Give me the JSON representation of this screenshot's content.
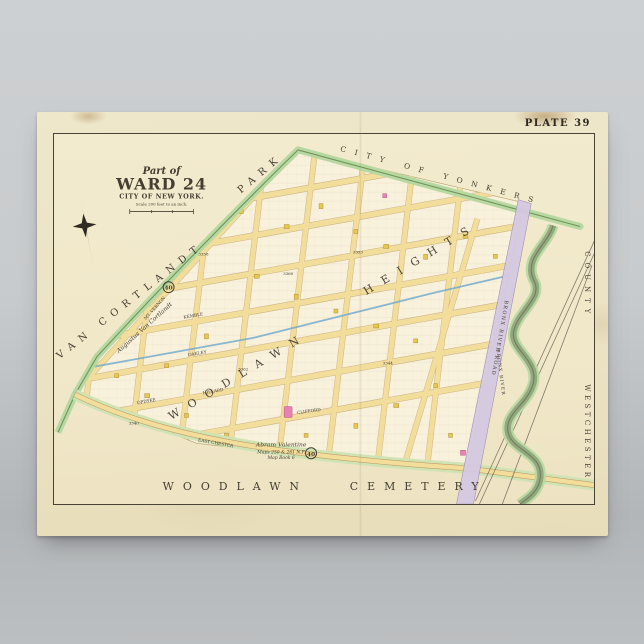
{
  "plate": "PLATE 39",
  "title": {
    "part_of": "Part of",
    "ward": "WARD 24",
    "city": "CITY OF NEW YORK.",
    "scale_note": "Scale 200 feet to an inch."
  },
  "regions": {
    "van_cortlandt": "VAN CORTLANDT",
    "park": "PARK",
    "city_of_yonkers": "CITY OF YONKERS",
    "woodlawn_big": "WOODLAWN",
    "heights_big": "HEIGHTS",
    "cemetery_word1": "WOODLAWN",
    "cemetery_word2": "CEMETERY",
    "westchester": "WESTCHESTER",
    "county": "COUNTY"
  },
  "features": {
    "bronx_river_road": "BRONX RIVER ROAD",
    "bronx_river": "BRONX RIVER",
    "aqueduct_owner": "Augustus Van Cortlandt",
    "note_line1": "Abram Valentine",
    "note_line2": "Maps 250 & 261 N.P.",
    "note_line3": "Map Book 6",
    "section_badge": "40"
  },
  "streets": [
    {
      "name": "MT. VERNON"
    },
    {
      "name": "KEMBLE"
    },
    {
      "name": "OAKLEY"
    },
    {
      "name": "HILLARD"
    },
    {
      "name": "OPDYKE"
    },
    {
      "name": "CLIFFORD"
    },
    {
      "name": "EAST CHESTER"
    }
  ],
  "blocks": [
    "3358",
    "3360",
    "3353",
    "3362",
    "3340",
    "3344"
  ],
  "palette": {
    "paper": "#ece3c4",
    "block_fill": "#f8f1dc",
    "street_yellow": "#f2dd9b",
    "park_green": "#b7d8a1",
    "railroad_purple": "#d5c9e2",
    "river_green": "#93a87e",
    "building_yellow": "#e8c84a",
    "building_pink": "#e882b2"
  }
}
